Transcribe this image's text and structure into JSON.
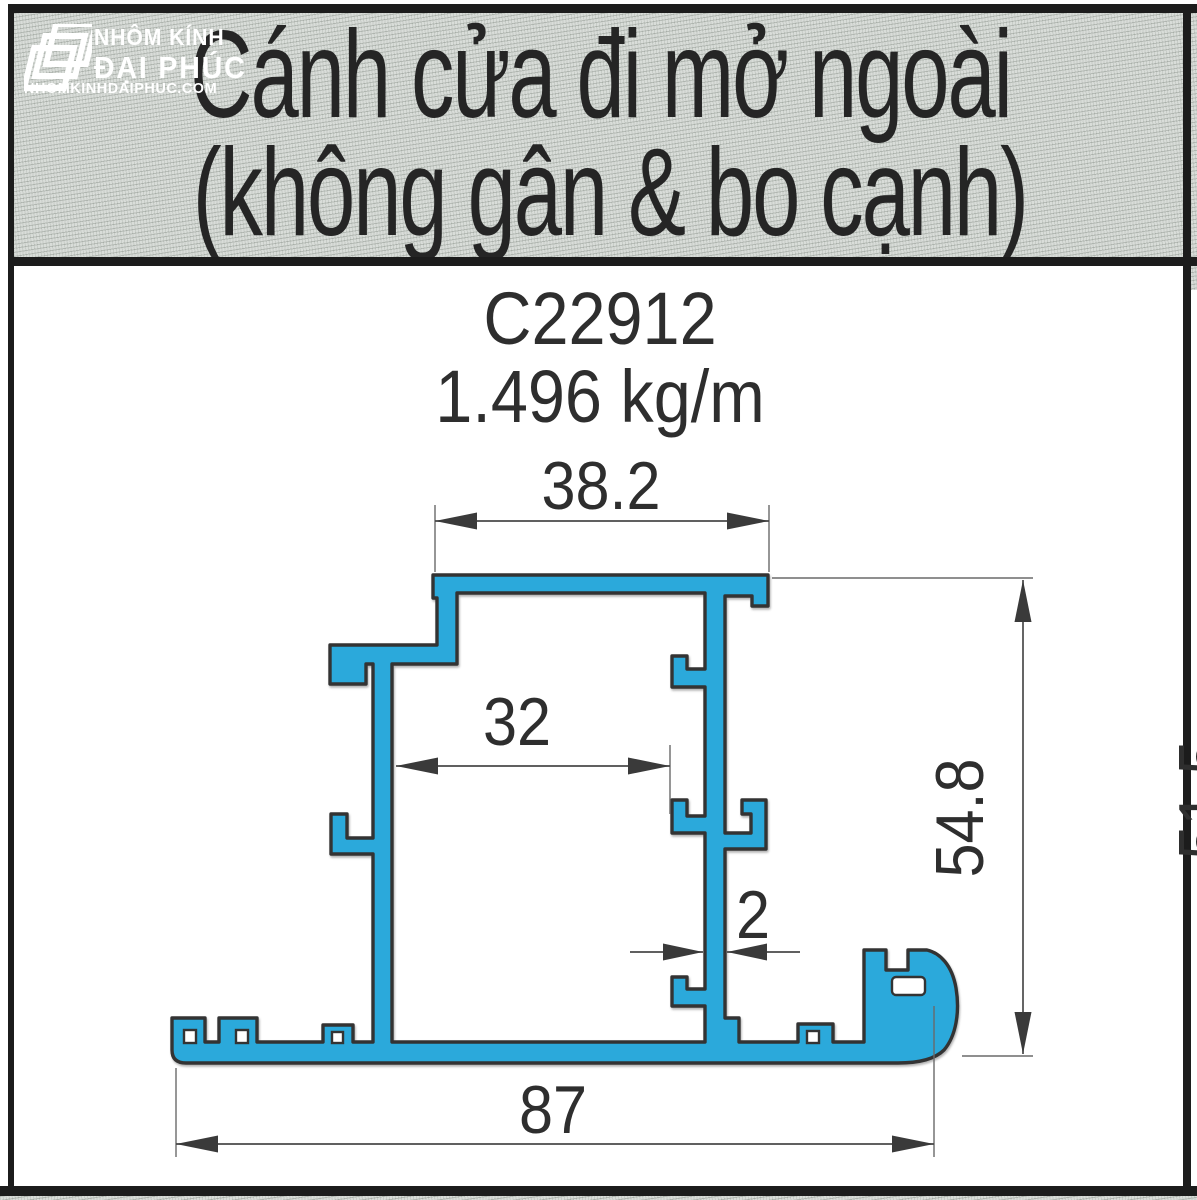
{
  "header": {
    "title_line1": "Cánh cửa đi mở ngoài",
    "title_line2": "(không gân & bo cạnh)",
    "logo": {
      "line1": "NHÔM KÍNH",
      "line2": "ĐẠI PHÚC",
      "line3": "NHOMKINHDAIPHUC.COM"
    }
  },
  "product": {
    "code": "C22912",
    "weight": "1.496 kg/m"
  },
  "dimensions": {
    "top_width": "38.2",
    "inner_width": "32",
    "wall_thickness": "2",
    "height": "54.8",
    "bottom_width": "87",
    "clipped_right": "51.5"
  },
  "colors": {
    "profile_fill": "#2BA9DB",
    "outline": "#333333",
    "header_bg": "#D9DDD9",
    "border": "#1C1C1C",
    "dimension": "#3A3A3A"
  }
}
